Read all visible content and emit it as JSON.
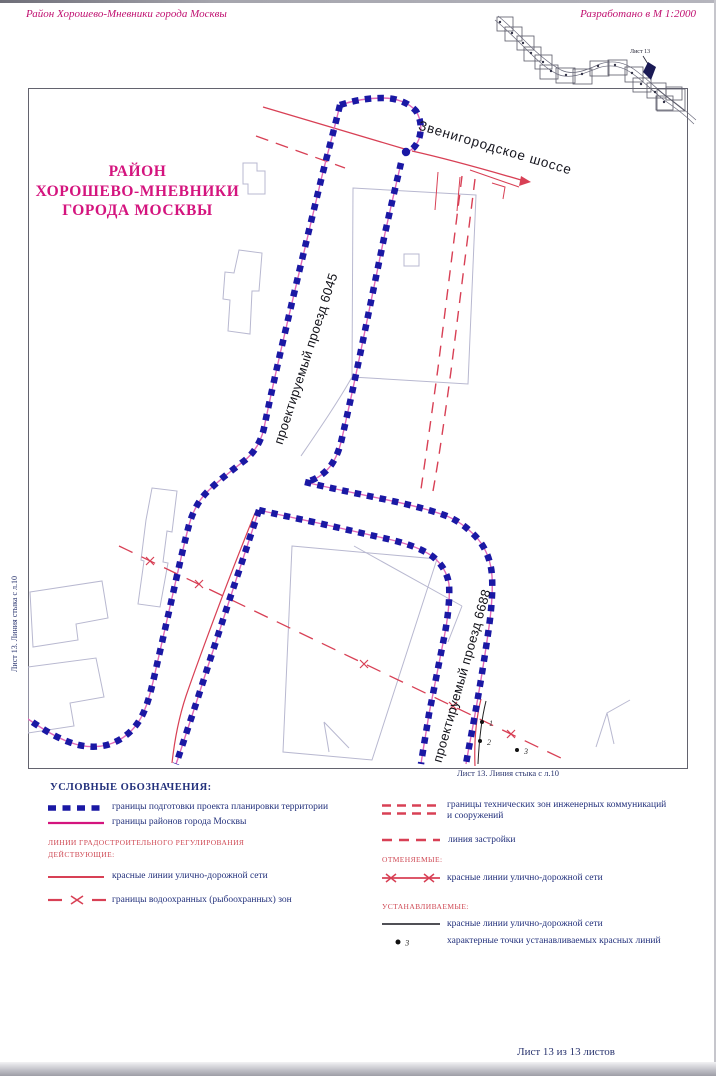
{
  "page": {
    "header_left": "Район Хорошево-Мневники города Москвы",
    "header_right": "Разработано в М 1:2000",
    "footer_sheet": "Лист 13 из 13 листов"
  },
  "index_map": {
    "sheet_label": "Лист 13"
  },
  "map": {
    "title_lines": [
      "РАЙОН",
      "ХОРОШЕВО-МНЕВНИКИ",
      "ГОРОДА МОСКВЫ"
    ],
    "road_labels": [
      {
        "text": "Звенигородское шоссе"
      },
      {
        "text": "проектируемый проезд 6045"
      },
      {
        "text": "проектируемый проезд 6688"
      }
    ],
    "edge_label_left": "Лист 13. Линия стыка с л.10",
    "edge_label_bottom": "Лист 13. Линия стыка с л.10",
    "point_labels": [
      "1",
      "2",
      "3"
    ]
  },
  "legend": {
    "title": "УСЛОВНЫЕ ОБОЗНАЧЕНИЯ:",
    "boundary_items": [
      {
        "symbol": "blue-dashed-line",
        "label": "границы подготовки проекта планировки территории"
      },
      {
        "symbol": "magenta-solid-line",
        "label": "границы районов города Москвы"
      }
    ],
    "regulation_heading": "ЛИНИИ ГРАДОСТРОИТЕЛЬНОГО РЕГУЛИРОВАНИЯ",
    "active_heading": "ДЕЙСТВУЮЩИЕ:",
    "active_items": [
      {
        "symbol": "red-solid-line",
        "label": "красные линии улично-дорожной сети"
      },
      {
        "symbol": "red-dash-x-line",
        "label": "границы водоохранных (рыбоохранных) зон"
      }
    ],
    "right_items": [
      {
        "symbol": "red-double-dashed-line",
        "label_line1": "границы технических зон инженерных коммуникаций",
        "label_line2": "и сооружений"
      },
      {
        "symbol": "red-dashed-line",
        "label": "линия застройки"
      }
    ],
    "cancelled_heading": "ОТМЕНЯЕМЫЕ:",
    "cancelled_items": [
      {
        "symbol": "red-line-x-ends",
        "label": "красные линии улично-дорожной сети"
      }
    ],
    "established_heading": "УСТАНАВЛИВАЕМЫЕ:",
    "established_items": [
      {
        "symbol": "black-solid-line",
        "label": "красные линии улично-дорожной сети"
      },
      {
        "symbol": "numbered-point",
        "point_label": "3",
        "label": "характерные точки устанавливаемых красных линий"
      }
    ]
  },
  "colors": {
    "magenta_title": "#d4147e",
    "header_magenta": "#c01070",
    "boundary_blue": "#1a18a4",
    "boundary_underlay": "#e06ab8",
    "red_line": "#d84055",
    "legend_navy": "#23317c",
    "building_gray": "#b8b8d0"
  }
}
